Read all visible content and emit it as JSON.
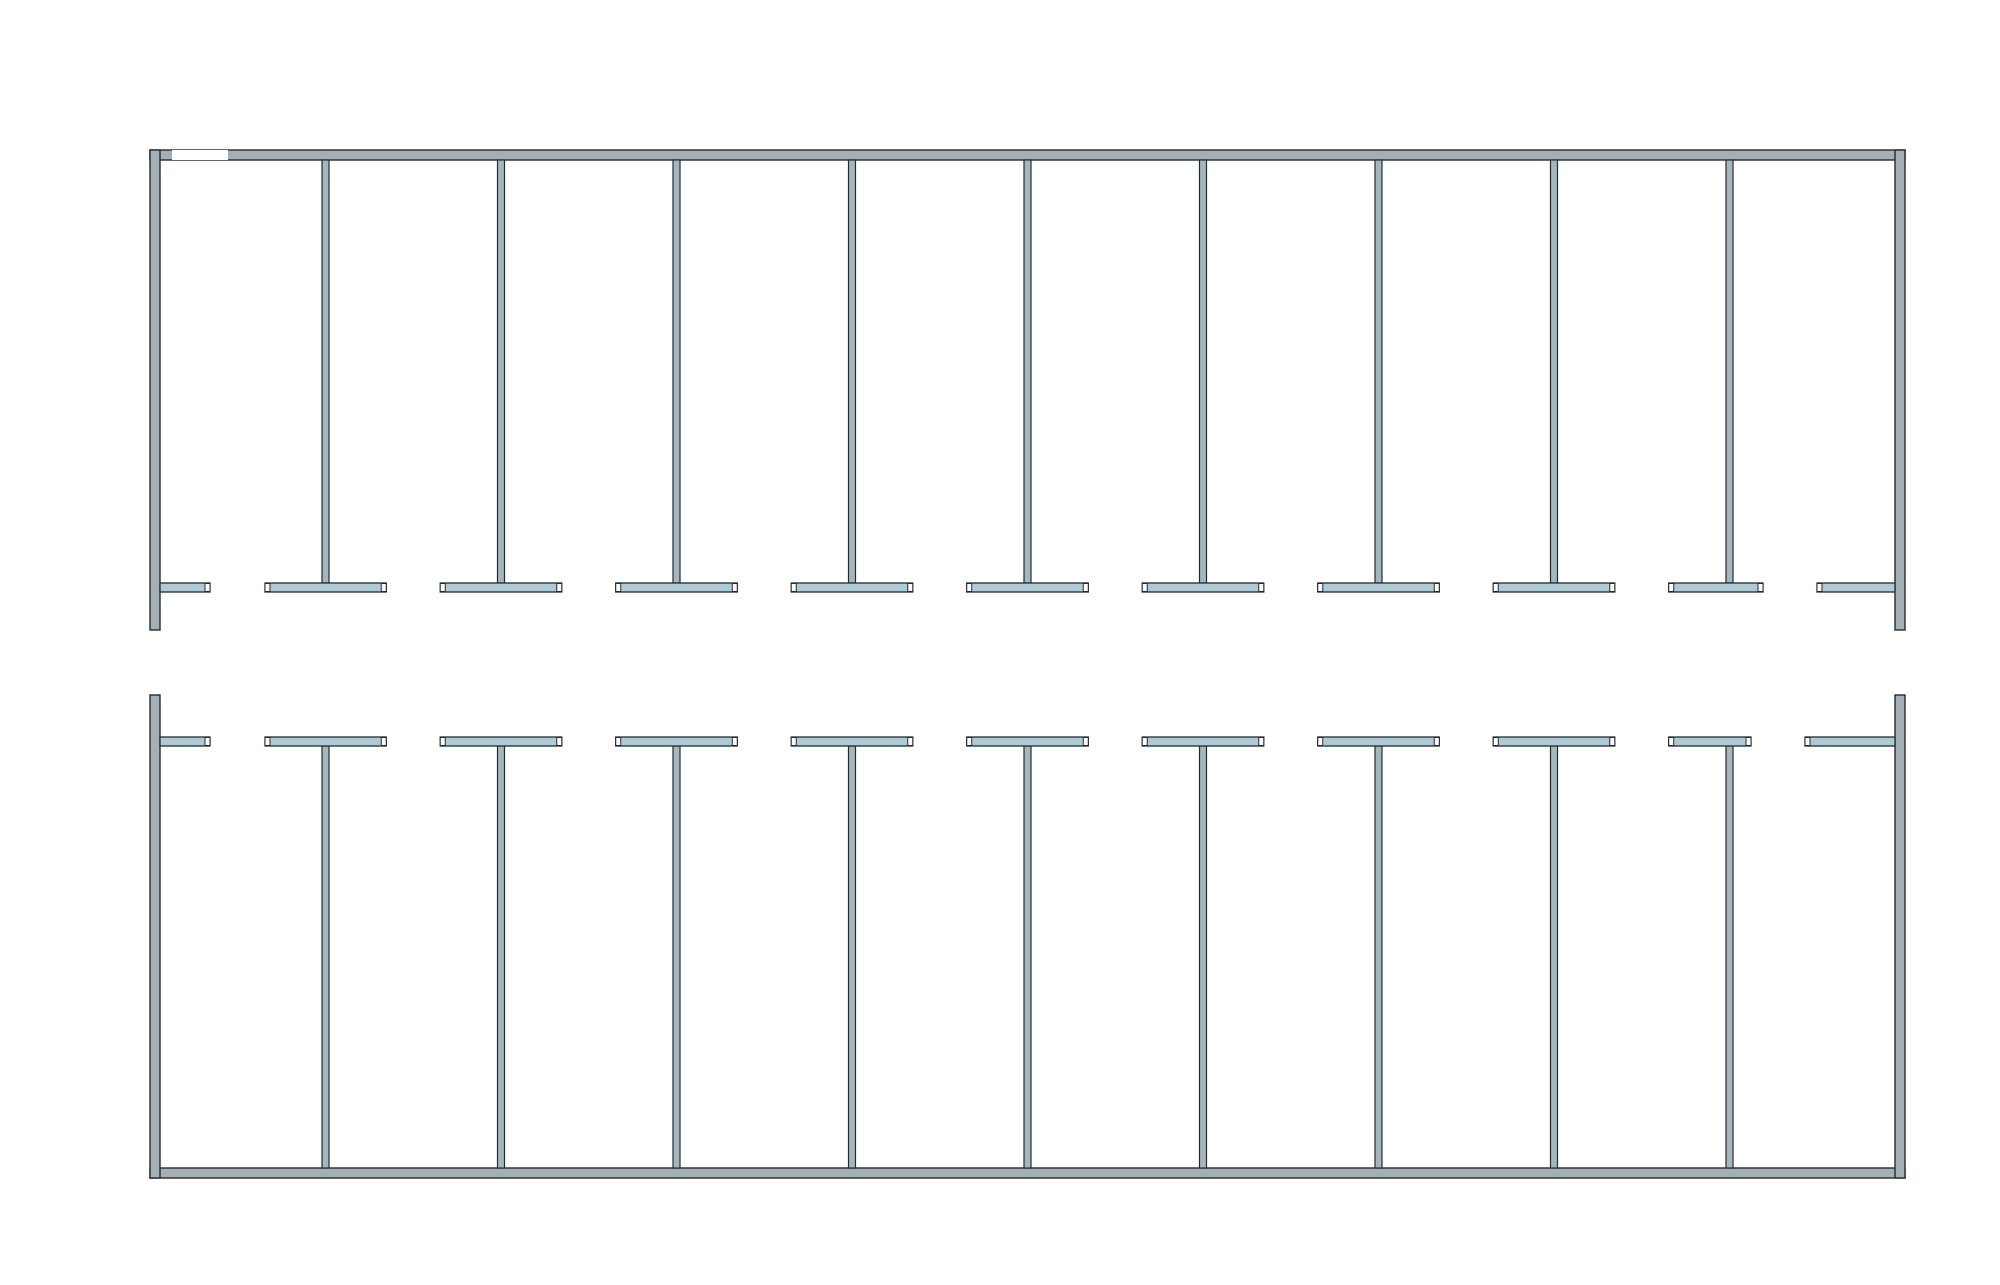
{
  "drawing": {
    "type": "container-dormitory floor plan",
    "dimensions": {
      "overall_width": "24 000",
      "module_width": "2 400",
      "module_count": 10,
      "overall_height": "14 000",
      "upper_room_depth": "6 000",
      "corridor_width": "2 000",
      "lower_room_depth": "6 000"
    },
    "watermark": {
      "text": "VANDA"
    },
    "layout": {
      "bedroom_count": 18,
      "beds_per_room": 2,
      "wardrobes_per_room": 2,
      "bathrooms": 2,
      "toilet_stalls_per_bathroom": 5,
      "sinks_per_bathroom": 1,
      "entrance_doors": 2
    },
    "colors": {
      "outline": "#262b30",
      "dim_text": "#111111",
      "wall_exterior": "#a4b0b6",
      "wall_partition": "#a6b6bf",
      "wall_corridor": "#aecbd5",
      "wall_stall": "#bcc9cf",
      "window_cap": "#555a5e",
      "bed_frame_yellow": "#e6ba4f",
      "bed_blanket_pink": "#e0cad0",
      "bed_blanket_border": "#463527",
      "bed_outline": "#2f2a22",
      "wardrobe_fill": "#b05f3e",
      "wardrobe_border": "#23272b",
      "fixture_stroke": "#1f1f1f",
      "dash_line": "#20262e",
      "watermark_red": "#ea8088",
      "watermark_blue": "#74afd8",
      "watermark_pale_blue": "#bcd9ec",
      "watermark_text_color": "#ffffff"
    }
  }
}
